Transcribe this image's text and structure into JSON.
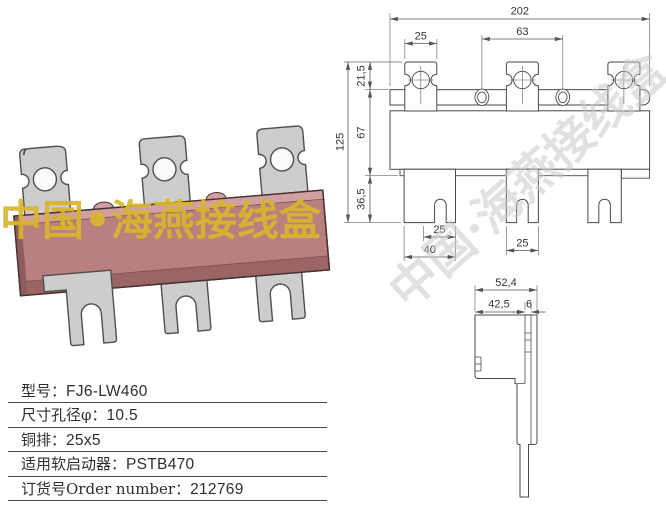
{
  "photo": {
    "watermark_text": "中国•海燕接线盒",
    "watermark_color": "#d9b52f",
    "body_color": "#b98080",
    "body_top_color": "#d1a0a0",
    "body_bottom_color": "#9b6565",
    "tab_color": "#cdcdcd"
  },
  "drawing": {
    "watermark_text": "中国·海燕接线盒",
    "front_view": {
      "dim_total_width": "202",
      "dim_hole_spacing": "63",
      "dim_top_tab_width": "25",
      "dim_total_height": "125",
      "dim_top_offset": "21,5",
      "dim_body_height": "67",
      "dim_bottom_height": "36,5",
      "dim_slot_offset": "25",
      "dim_left_tab_width": "40",
      "dim_mid_tab_width": "25"
    },
    "side_view": {
      "dim_total_depth": "52,4",
      "dim_body_depth": "42,5",
      "dim_plate_thickness": "6"
    }
  },
  "spec_table": {
    "rows": [
      {
        "label": "型号：",
        "value": "FJ6-LW460"
      },
      {
        "label": "尺寸孔径φ：",
        "value": "10.5"
      },
      {
        "label": "铜排：",
        "value": "25x5"
      },
      {
        "label": "适用软启动器：",
        "value": "PSTB470"
      },
      {
        "label": "订货号Order number：",
        "value": "212769"
      }
    ]
  }
}
